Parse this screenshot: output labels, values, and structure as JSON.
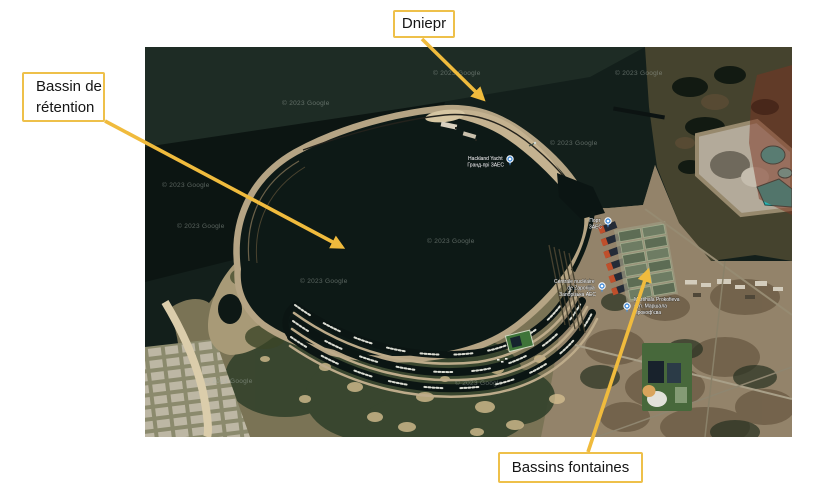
{
  "figure": {
    "type": "annotated-satellite-map",
    "labels": {
      "dniepr": "Dniepr",
      "bassin_retention": [
        "Bassin de",
        "rétention"
      ],
      "bassins_fontaines": "Bassins fontaines"
    },
    "style": {
      "arrow_color": "#F0BB3D",
      "box_border_color": "#EEC04A",
      "box_background": "#FFFFFF",
      "text_color": "#151515"
    }
  },
  "map": {
    "watermark": "© 2023 Google",
    "pins": [
      {
        "id": "port",
        "lines": [
          "Hackland Yacht",
          "Гранд-прі ЗАЕС"
        ]
      },
      {
        "id": "zaes_port",
        "lines": [
          "Порт",
          "ЗАЕС"
        ]
      },
      {
        "id": "centrale",
        "lines": [
          "Centrale nucléaire",
          "de Zaporijjia",
          "Запорізька АЕС"
        ]
      },
      {
        "id": "marshala",
        "lines": [
          "Marshala Prokofieva",
          "вул. Маршала",
          "Прокоф'єва"
        ]
      }
    ]
  }
}
